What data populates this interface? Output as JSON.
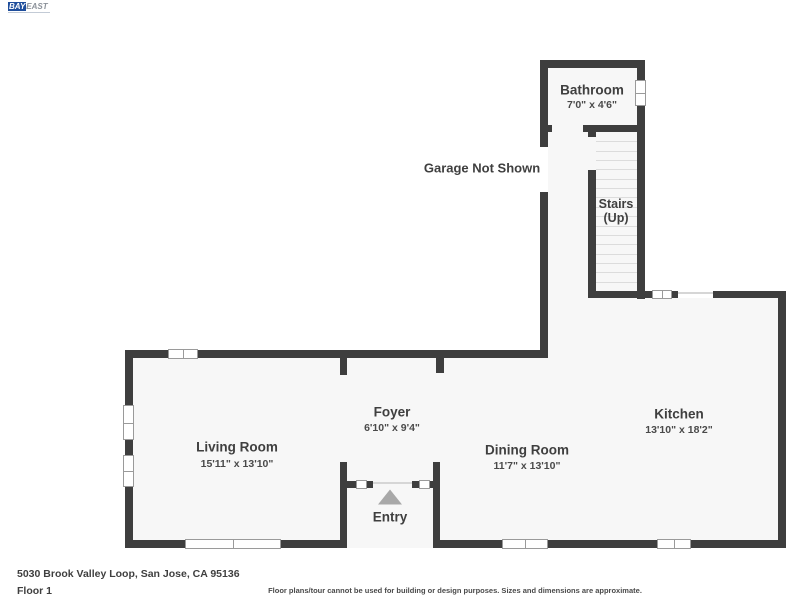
{
  "logo": {
    "part1": "BAY",
    "part2": "EAST"
  },
  "notes": {
    "garage": "Garage Not Shown"
  },
  "rooms": {
    "bathroom": {
      "name": "Bathroom",
      "dims": "7'0\" x 4'6\""
    },
    "stairs": {
      "line1": "Stairs",
      "line2": "(Up)"
    },
    "kitchen": {
      "name": "Kitchen",
      "dims": "13'10\" x 18'2\""
    },
    "foyer": {
      "name": "Foyer",
      "dims": "6'10\" x 9'4\""
    },
    "living_room": {
      "name": "Living Room",
      "dims": "15'11\" x 13'10\""
    },
    "dining_room": {
      "name": "Dining Room",
      "dims": "11'7\" x 13'10\""
    },
    "entry": {
      "name": "Entry"
    }
  },
  "footer": {
    "address": "5030 Brook Valley Loop, San Jose, CA 95136",
    "floor": "Floor 1",
    "disclaimer": "Floor plans/tour cannot be used for building or design purposes. Sizes and dimensions are approximate."
  },
  "colors": {
    "wall": "#3e3e3e",
    "floor": "#f7f7f7",
    "logo_blue": "#1f4e9c"
  }
}
